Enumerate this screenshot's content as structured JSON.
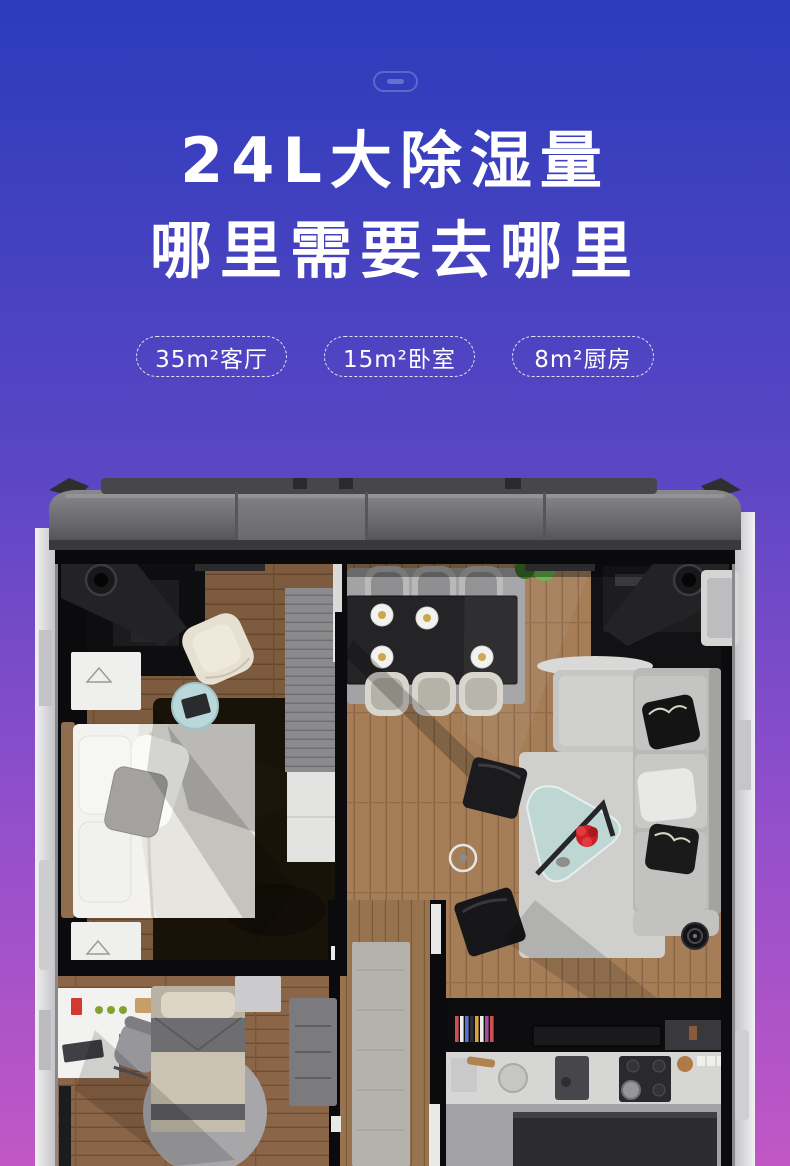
{
  "theme": {
    "bg-top": "#2b3cbb",
    "bg-mid": "#5a46c4",
    "bg-lower": "#8f4ecb",
    "bg-bottom": "#c157c5",
    "title-color": "#ffffff",
    "badge-border": "rgba(255,255,255,0.85)"
  },
  "hero": {
    "decoration_icon": "capsule-outline-icon",
    "title_line1": "24L大除湿量",
    "title_line2": "哪里需要去哪里",
    "badges": [
      {
        "label": "35m²客厅"
      },
      {
        "label": "15m²卧室"
      },
      {
        "label": "8m²厨房"
      }
    ]
  },
  "floorplan": {
    "kind": "3d-top-down-apartment-render-inside-dehumidifier-casing",
    "regions": [
      "master-bedroom",
      "dining-area",
      "living-room",
      "second-bedroom",
      "hallway",
      "kitchen"
    ],
    "palette": {
      "casing_gray": "#6d6d71",
      "rail_white": "#e9e9eb",
      "interior_black": "#0b0b0d",
      "wood_light": "#a57e58",
      "wood_dark": "#7c5b3e",
      "rug_dark": "#181209",
      "rug_light": "#cfcfcd",
      "sofa_gray": "#bdbdbb",
      "accent_flower_red": "#cc2127",
      "plant_green": "#478a2a"
    }
  }
}
